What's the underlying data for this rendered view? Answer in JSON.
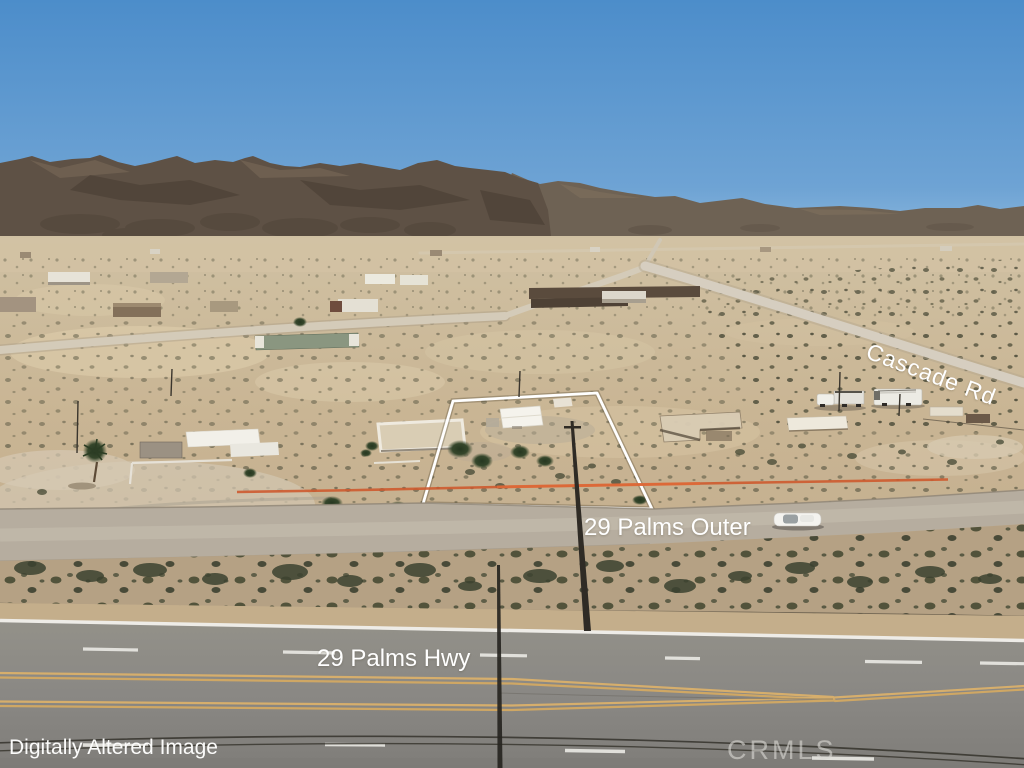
{
  "image": {
    "kind": "aerial drone real-estate photograph",
    "subject": "vacant desert land parcel outlined in white near highway, Joshua Tree / 29 Palms area",
    "scene_elements": [
      "blue sky",
      "desert mountain ridge",
      "scattered rural homes",
      "dirt cross streets",
      "white property boundary outline",
      "orange construction fencing",
      "white sedan on frontage road",
      "two white utility trucks on Cascade Rd",
      "paved divided highway in foreground",
      "utility poles and power lines"
    ]
  },
  "labels": {
    "disclaimer": "Digitally Altered Image",
    "watermark": "CRMLS",
    "highway": "29 Palms Hwy",
    "outer_road": "29 Palms Outer",
    "cross_road": "Cascade Rd"
  },
  "colors": {
    "sky_top": "#4c8dca",
    "sky_horizon": "#90bbde",
    "mountain_dark": "#5e5145",
    "mountain_far": "#6e6254",
    "desert_sand": "#c9b696",
    "road_dirt": "#b6ad9f",
    "asphalt": "#8d8b87",
    "lane_yellow": "#d4ab68",
    "lane_white": "#eceae5",
    "lot_outline": "#ffffff",
    "construction_fence": "#cd5a2f"
  }
}
